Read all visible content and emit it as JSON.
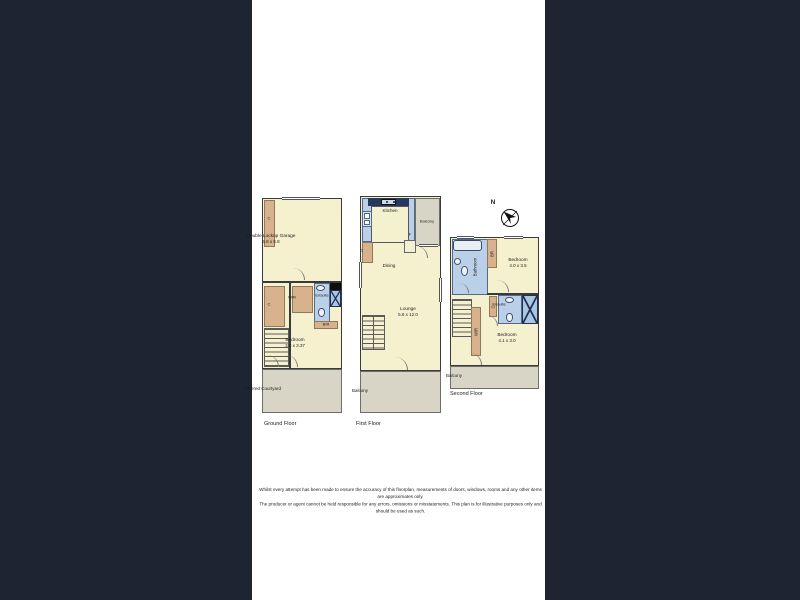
{
  "colors": {
    "letterbox": "#1d2533",
    "room_fill": "#f5f1cf",
    "wardrobe_fill": "#d8b28c",
    "wet_area_fill": "#b9d0e8",
    "outdoor_fill": "#d9d5c6",
    "wall": "#3a3a3a",
    "counter": "#24395b"
  },
  "compass": {
    "north_label": "N"
  },
  "floors": {
    "ground": {
      "title": "Ground Floor",
      "garage_name": "Double Lockup Garage",
      "garage_dim": "5.8 x 5.8",
      "closet_top": "C",
      "closet": "C",
      "wir": "WIR",
      "ensuite": "Ensuite",
      "bir": "BIR",
      "bedroom_name": "Bedroom",
      "bedroom_dim": "3.5 x 3.37",
      "courtyard": "Covered Courtyard"
    },
    "first": {
      "title": "First Floor",
      "kitchen": "Kitchen",
      "balcony_top": "Balcony",
      "closet": "C",
      "fridge": "F",
      "dining": "Dining",
      "lounge_name": "Lounge",
      "lounge_dim": "5.6 x 12.0",
      "balcony_bottom": "Balcony"
    },
    "second": {
      "title": "Second Floor",
      "bathroom": "Bathroom",
      "robe": "BR",
      "bedroom1_name": "Bedroom",
      "bedroom1_dim": "4.0 x 3.5",
      "closet": "C",
      "ensuite": "Ensuite",
      "wir": "WIR",
      "bedroom2_name": "Bedroom",
      "bedroom2_dim": "4.1 x 3.0",
      "balcony": "Balcony"
    }
  },
  "disclaimer": {
    "line1": "Whilst every attempt has been made to ensure the accuracy of this floorplan, measurements of doors, windows, rooms and any other items are approximates only.",
    "line2": "The producer or agent cannot be held responsible for any errors, omissions or misstatements. This plan is for illustrative purposes only and should be used as such."
  }
}
